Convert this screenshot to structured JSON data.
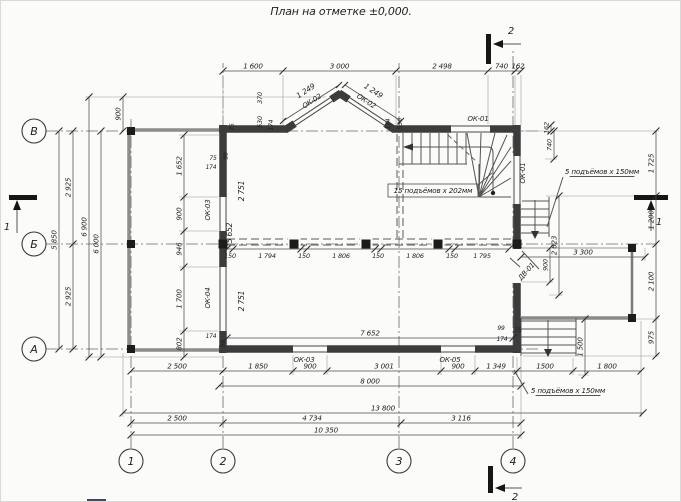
{
  "title": {
    "text": "План на отметке ±0,000."
  },
  "axes": {
    "rows": [
      {
        "label": "В",
        "x": 33,
        "y": 130
      },
      {
        "label": "Б",
        "x": 33,
        "y": 243
      },
      {
        "label": "А",
        "x": 33,
        "y": 348
      }
    ],
    "cols": [
      {
        "label": "1",
        "x": 130,
        "y": 460
      },
      {
        "label": "2",
        "x": 222,
        "y": 460
      },
      {
        "label": "3",
        "x": 398,
        "y": 460
      },
      {
        "label": "4",
        "x": 512,
        "y": 460
      }
    ]
  },
  "sections": [
    {
      "label": "1",
      "lx": 6,
      "ly": 229
    },
    {
      "label": "1",
      "lx": 658,
      "ly": 224
    },
    {
      "label": "2",
      "lx": 510,
      "ly": 33
    },
    {
      "label": "2",
      "lx": 514,
      "ly": 499
    }
  ],
  "chains": [
    {
      "o": "h",
      "p": 70,
      "t": [
        222,
        282,
        395,
        487,
        514,
        520
      ],
      "l": [
        "1 600",
        "3 000",
        "2 498",
        "740",
        "162"
      ]
    },
    {
      "o": "h",
      "p": 370,
      "t": [
        130,
        222,
        292,
        326,
        440,
        474,
        516,
        572,
        640
      ],
      "l": [
        "2 500",
        "1 850",
        "900",
        "3 001",
        "900",
        "1 349",
        "1500",
        "1 800"
      ]
    },
    {
      "o": "h",
      "p": 385,
      "t": [
        218,
        520
      ],
      "l": [
        "8 000"
      ]
    },
    {
      "o": "h",
      "p": 412,
      "t": [
        122,
        642
      ],
      "l": [
        "13 800"
      ]
    },
    {
      "o": "h",
      "p": 422,
      "t": [
        130,
        222,
        400,
        520
      ],
      "l": [
        "2 500",
        "4 734",
        "3 116"
      ]
    },
    {
      "o": "h",
      "p": 434,
      "t": [
        130,
        520
      ],
      "l": [
        "10 350"
      ]
    },
    {
      "o": "v",
      "p": 58,
      "t": [
        130,
        348
      ],
      "l": [
        "5 850"
      ]
    },
    {
      "o": "v",
      "p": 72,
      "t": [
        130,
        243,
        348
      ],
      "l": [
        "2 925",
        "2 925"
      ]
    },
    {
      "o": "v",
      "p": 88,
      "t": [
        96,
        356
      ],
      "l": [
        "6 900"
      ]
    },
    {
      "o": "v",
      "p": 100,
      "t": [
        130,
        356
      ],
      "l": [
        "6 000"
      ]
    },
    {
      "o": "v",
      "p": 122,
      "t": [
        96,
        130
      ],
      "l": [
        "900"
      ]
    },
    {
      "o": "v",
      "p": 183,
      "t": [
        134,
        196,
        230,
        266,
        330,
        356
      ],
      "l": [
        "1 652",
        "900",
        "946",
        "1 700",
        "802"
      ]
    },
    {
      "o": "h",
      "p": 248,
      "t": [
        226,
        232,
        300,
        306,
        374,
        380,
        448,
        454,
        508
      ],
      "l": [
        "150",
        "1 794",
        "150",
        "1 806",
        "150",
        "1 806",
        "150",
        "1 795"
      ],
      "lb": 1,
      "s": 6.5
    },
    {
      "o": "h",
      "p": 337,
      "t": [
        226,
        512
      ],
      "l": [
        "7 652"
      ]
    },
    {
      "o": "v",
      "p": 655,
      "t": [
        130,
        195,
        243,
        318,
        355
      ],
      "l": [
        "1 725",
        "1 200",
        "2 100",
        "975"
      ]
    },
    {
      "o": "v",
      "p": 550,
      "t": [
        124,
        130
      ],
      "l": [
        "162"
      ],
      "s": 6.5
    },
    {
      "o": "v",
      "p": 553,
      "t": [
        130,
        158
      ],
      "l": [
        "740"
      ],
      "s": 6.5
    },
    {
      "o": "v",
      "p": 558,
      "t": [
        195,
        294
      ],
      "l": [
        "2 623"
      ]
    },
    {
      "o": "h",
      "p": 256,
      "t": [
        520,
        644
      ],
      "l": [
        "3 300"
      ]
    },
    {
      "o": "v",
      "p": 549,
      "t": [
        247,
        281
      ],
      "l": [
        "900"
      ],
      "s": 6.5
    },
    {
      "o": "v",
      "p": 584,
      "t": [
        318,
        374
      ],
      "l": [
        "1 500"
      ]
    }
  ],
  "labels": [
    {
      "t": "1 249",
      "x": 306,
      "y": 92,
      "r": -33
    },
    {
      "t": "ОК-02",
      "x": 312,
      "y": 102,
      "r": -33,
      "s": 7
    },
    {
      "t": "1 249",
      "x": 371,
      "y": 92,
      "r": 33
    },
    {
      "t": "ОК-02",
      "x": 364,
      "y": 102,
      "r": 33,
      "s": 7
    },
    {
      "t": "370",
      "x": 261,
      "y": 97,
      "r": -90,
      "s": 6.5
    },
    {
      "t": "530",
      "x": 261,
      "y": 121,
      "r": -90,
      "s": 6.5
    },
    {
      "t": "174",
      "x": 272,
      "y": 124,
      "r": -90,
      "s": 6
    },
    {
      "t": "75",
      "x": 233,
      "y": 126,
      "r": -90,
      "s": 6
    },
    {
      "t": "174",
      "x": 389,
      "y": 123,
      "r": -90,
      "s": 6
    },
    {
      "t": "530",
      "x": 401,
      "y": 123,
      "r": -90,
      "s": 6.5
    },
    {
      "t": "ОК-01",
      "x": 477,
      "y": 120,
      "s": 7
    },
    {
      "t": "ОК-01",
      "x": 524,
      "y": 172,
      "r": -90,
      "s": 7
    },
    {
      "t": "ДВ-01",
      "x": 527,
      "y": 272,
      "r": -48,
      "s": 7
    },
    {
      "t": "ОК-03",
      "x": 209,
      "y": 209,
      "r": -90,
      "s": 7
    },
    {
      "t": "ОК-04",
      "x": 209,
      "y": 297,
      "r": -90,
      "s": 7
    },
    {
      "t": "2 751",
      "x": 243,
      "y": 190,
      "r": -90
    },
    {
      "t": "5 652",
      "x": 231,
      "y": 232,
      "r": -90
    },
    {
      "t": "2 751",
      "x": 243,
      "y": 300,
      "r": -90
    },
    {
      "t": "75",
      "x": 212,
      "y": 159,
      "s": 6
    },
    {
      "t": "174",
      "x": 210,
      "y": 168,
      "s": 6
    },
    {
      "t": "99",
      "x": 227,
      "y": 155,
      "r": -90,
      "s": 6
    },
    {
      "t": "174",
      "x": 210,
      "y": 337,
      "s": 6
    },
    {
      "t": "99",
      "x": 224,
      "y": 343,
      "r": -90,
      "s": 6
    },
    {
      "t": "ОК-03",
      "x": 303,
      "y": 361,
      "s": 7
    },
    {
      "t": "ОК-05",
      "x": 449,
      "y": 361,
      "s": 7
    },
    {
      "t": "99",
      "x": 500,
      "y": 329,
      "s": 6
    },
    {
      "t": "75",
      "x": 517,
      "y": 331,
      "s": 6
    },
    {
      "t": "174",
      "x": 501,
      "y": 340,
      "s": 6
    },
    {
      "t": "15 подъёмов x 202мм",
      "x": 432,
      "y": 192,
      "s": 7.2,
      "box": [
        387,
        183,
        90,
        13
      ]
    },
    {
      "t": "5 подъёмов x 150мм",
      "x": 601,
      "y": 173,
      "s": 7.2,
      "u": 1
    },
    {
      "t": "5 подъёмов x 150мм",
      "x": 567,
      "y": 392,
      "s": 7.2,
      "u": 1
    }
  ]
}
